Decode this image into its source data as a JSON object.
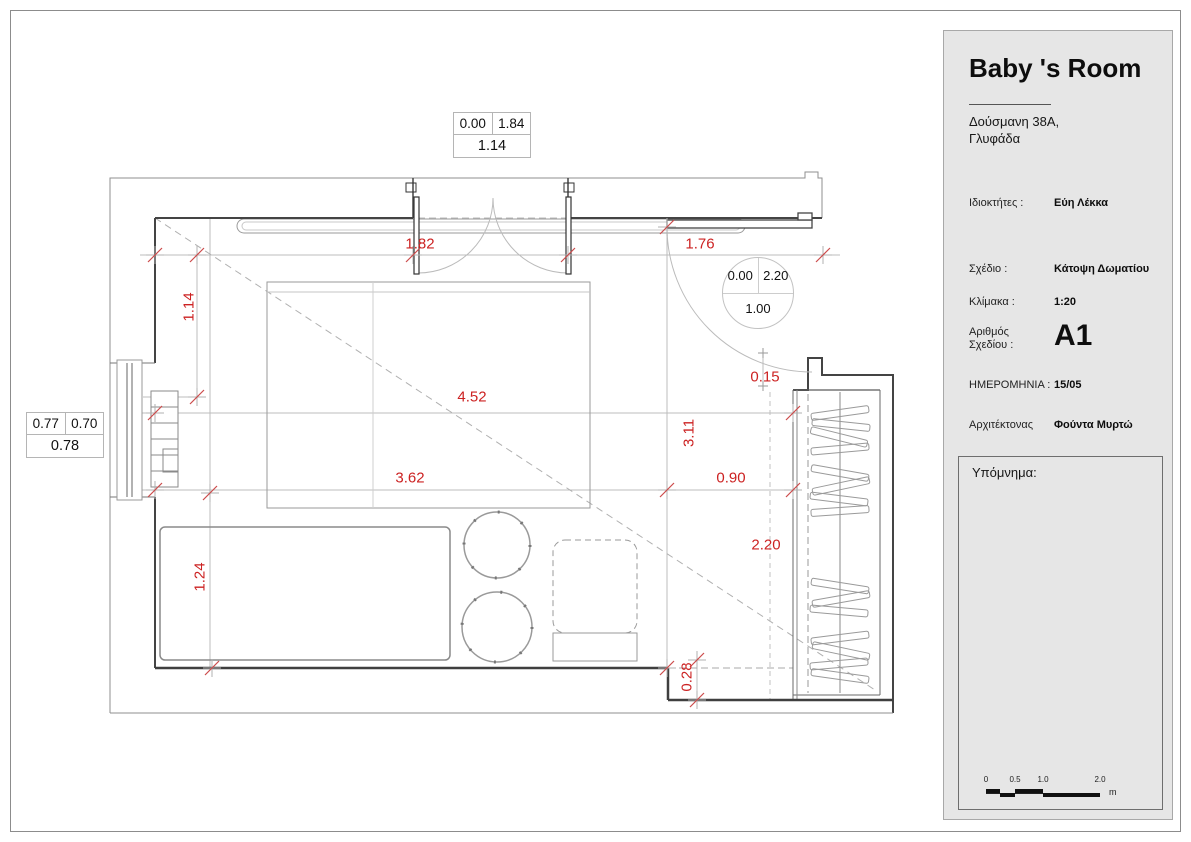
{
  "title_block": {
    "title": "Baby 's Room",
    "address_line1": "Δούσμανη 38Α,",
    "address_line2": "Γλυφάδα",
    "fields": {
      "owner_label": "Ιδιοκτήτες :",
      "owner_value": "Εύη Λέκκα",
      "drawing_label": "Σχέδιο :",
      "drawing_value": "Κάτοψη Δωματίου",
      "scale_label": "Κλίμακα :",
      "scale_value": "1:20",
      "number_label": "Αριθμός Σχεδίου :",
      "number_value": "A1",
      "date_label": "ΗΜΕΡΟΜΗΝΙΑ :",
      "date_value": "15/05",
      "architect_label": "Αρχιτέκτονας",
      "architect_value": "Φούντα Μυρτώ"
    },
    "legend_label": "Υπόμνημα:"
  },
  "scale_bar": {
    "ticks": [
      "0",
      "0.5",
      "1.0",
      "2.0"
    ],
    "unit": "m"
  },
  "plan": {
    "dimensions": {
      "shelf_width": "1.82",
      "left_segment": "1.14",
      "right_opening": "1.76",
      "total_width": "4.52",
      "room_width": "3.62",
      "closet_gap": "0.90",
      "room_depth": "3.11",
      "closet_depth": "2.20",
      "closet_offset": "0.15",
      "wall_step": "0.28",
      "bed_width": "1.24"
    },
    "door_tag_top": {
      "left": "0.00",
      "right": "1.84",
      "bottom": "1.14"
    },
    "window_tag_left": {
      "left": "0.77",
      "right": "0.70",
      "bottom": "0.78"
    },
    "door_tag_circle": {
      "left": "0.00",
      "right": "2.20",
      "bottom": "1.00"
    }
  },
  "colors": {
    "dimension_red": "#cc2222",
    "panel_bg": "#e6e6e6"
  }
}
